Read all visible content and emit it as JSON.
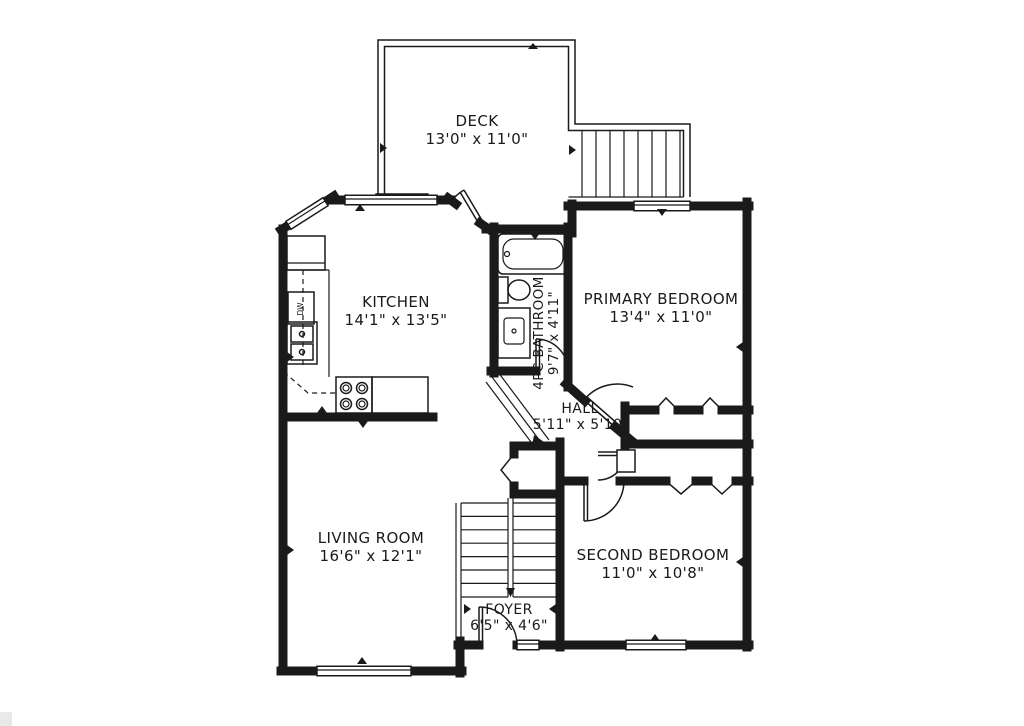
{
  "plan": {
    "colors": {
      "line": "#1a1a1a",
      "background": "#ffffff"
    },
    "rooms": {
      "deck": {
        "name": "DECK",
        "dims": "13'0\" x 11'0\""
      },
      "kitchen": {
        "name": "KITCHEN",
        "dims": "14'1\" x 13'5\""
      },
      "bathroom": {
        "name": "4PC BATHROOM",
        "dims": "9'7\" x 4'11\""
      },
      "primary_bedroom": {
        "name": "PRIMARY BEDROOM",
        "dims": "13'4\" x 11'0\""
      },
      "hall": {
        "name": "HALL",
        "dims": "5'11\" x 5'10\""
      },
      "living_room": {
        "name": "LIVING ROOM",
        "dims": "16'6\" x 12'1\""
      },
      "second_bedroom": {
        "name": "SECOND BEDROOM",
        "dims": "11'0\" x 10'8\""
      },
      "foyer": {
        "name": "FOYER",
        "dims": "6'5\" x 4'6\""
      }
    },
    "fixtures": {
      "dishwasher_label": "DW"
    }
  }
}
